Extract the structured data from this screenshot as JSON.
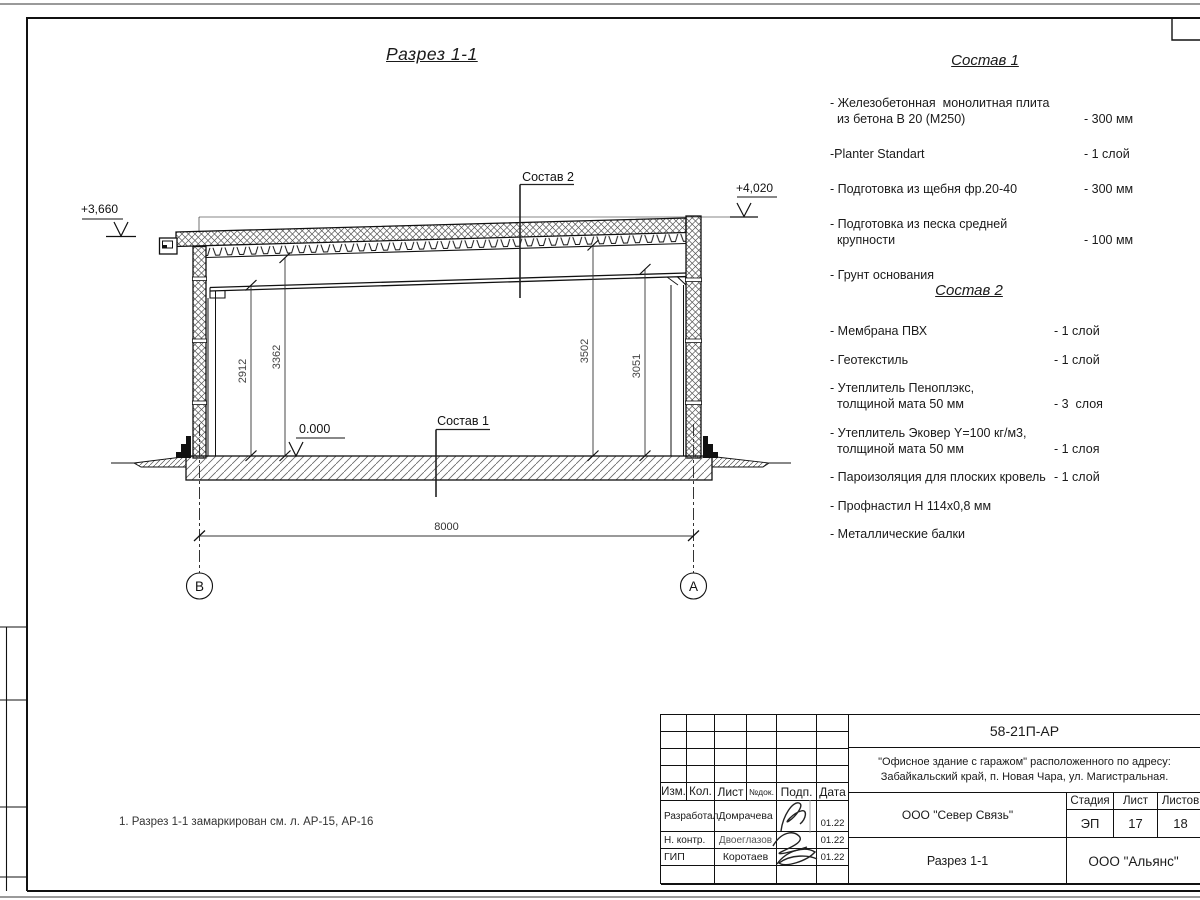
{
  "section": {
    "title": "Разрез 1-1",
    "elev_left": "+3,660",
    "elev_right": "+4,020",
    "elev_floor": "0.000",
    "dim_left_inner": "2912",
    "dim_left_outer": "3362",
    "dim_right_outer": "3502",
    "dim_right_inner": "3051",
    "dim_span": "8000",
    "axis_left": "В",
    "axis_right": "А",
    "ref_sostav2": "Состав 2",
    "ref_sostav1": "Состав 1",
    "note": "1. Разрез 1-1 замаркирован см. л. АР-15, АР-16"
  },
  "sostav1": {
    "title": "Состав 1",
    "items": [
      {
        "name": "- Железобетонная  монолитная плита\n  из бетона В 20 (М250)",
        "value": "- 300 мм"
      },
      {
        "name": "-Planter Standart",
        "value": "- 1 слой"
      },
      {
        "name": "- Подготовка из щебня фр.20-40",
        "value": "- 300 мм"
      },
      {
        "name": "- Подготовка из песка средней\n  крупности",
        "value": "- 100 мм"
      },
      {
        "name": "- Грунт основания",
        "value": ""
      }
    ]
  },
  "sostav2": {
    "title": "Состав 2",
    "items": [
      {
        "name": "- Мембрана ПВХ",
        "value": "- 1 слой"
      },
      {
        "name": "- Геотекстиль",
        "value": "- 1 слой"
      },
      {
        "name": "- Утеплитель Пеноплэкс,\n  толщиной мата 50 мм",
        "value": "- 3  слоя"
      },
      {
        "name": "- Утеплитель Эковер Y=100 кг/м3,\n  толщиной мата 50 мм",
        "value": "- 1 слоя"
      },
      {
        "name": "- Пароизоляция для плоских кровель",
        "value": "- 1 слой"
      },
      {
        "name": "- Профнастил Н 114х0,8 мм",
        "value": ""
      },
      {
        "name": "- Металлические балки",
        "value": ""
      }
    ]
  },
  "titleblock": {
    "doc_number": "58-21П-АР",
    "project": "\"Офисное здание с гаражом\" расположенного по адресу:\nЗабайкальский край, п. Новая Чара, ул. Магистральная.",
    "header": {
      "izm": "Изм.",
      "kol": "Кол.",
      "list": "Лист",
      "ndok": "№док.",
      "podp": "Подп.",
      "data": "Дата"
    },
    "rows": [
      {
        "role": "Разработал",
        "name": "Домрачева",
        "date": "01.22"
      },
      {
        "role": "Н. контр.",
        "name": "Двоеглазов",
        "date": "01.22"
      },
      {
        "role": "ГИП",
        "name": "Коротаев",
        "date": "01.22"
      }
    ],
    "company": "ООО \"Север Связь\"",
    "sheet_title": "Разрез 1-1",
    "firm": "ООО \"Альянс\"",
    "stage_label": "Стадия",
    "sheet_label": "Лист",
    "sheets_label": "Листов",
    "stage": "ЭП",
    "sheet": "17",
    "sheets": "18"
  }
}
